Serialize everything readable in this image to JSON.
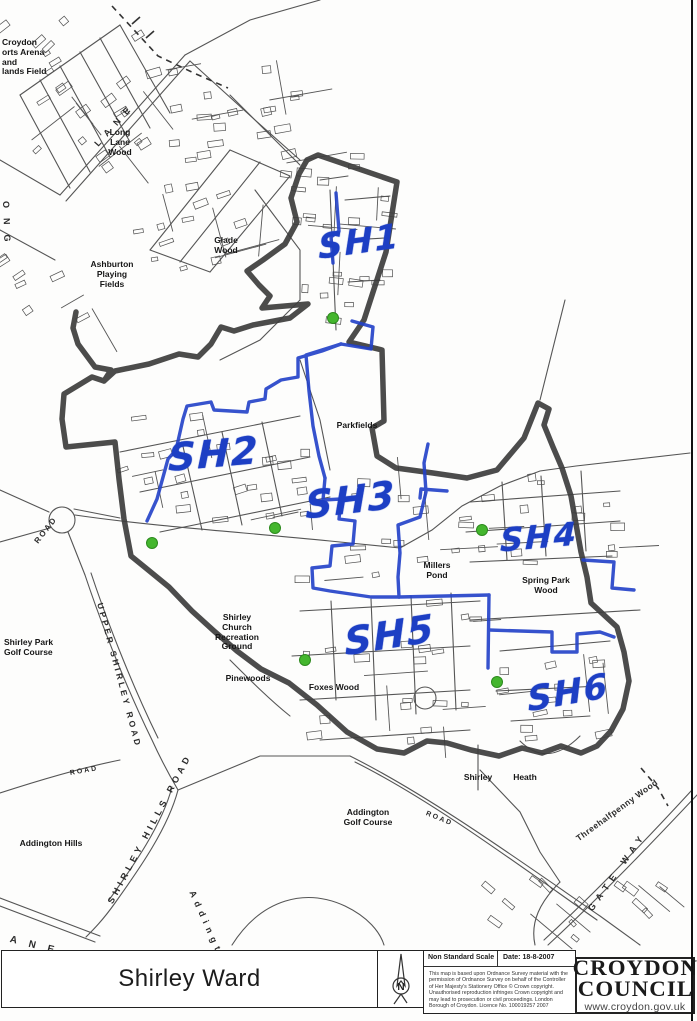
{
  "colors": {
    "boundary": "#3d3d3d",
    "district_line": "#2140c8",
    "street": "#555555",
    "green_marker": "#44b62e",
    "label_blue": "#1d3fc4"
  },
  "map": {
    "district_labels": [
      {
        "id": "sh1",
        "label": "SH1",
        "x": 318,
        "y": 222,
        "rot": -8,
        "size": 34
      },
      {
        "id": "sh2",
        "label": "SH2",
        "x": 168,
        "y": 432,
        "rot": -5,
        "size": 38
      },
      {
        "id": "sh3",
        "label": "SH3",
        "x": 305,
        "y": 478,
        "rot": -7,
        "size": 38
      },
      {
        "id": "sh4",
        "label": "SH4",
        "x": 500,
        "y": 518,
        "rot": -5,
        "size": 32
      },
      {
        "id": "sh5",
        "label": "SH5",
        "x": 344,
        "y": 613,
        "rot": -9,
        "size": 38
      },
      {
        "id": "sh6",
        "label": "SH6",
        "x": 527,
        "y": 673,
        "rot": -10,
        "size": 34
      }
    ],
    "place_labels": [
      {
        "id": "croydon-arena",
        "lines": [
          "Croydon",
          "orts Arena",
          "and",
          "lands Field"
        ],
        "x": 2,
        "y": 38,
        "align": "left"
      },
      {
        "id": "long-lane-wood",
        "lines": [
          "Long",
          "Lane",
          "Wood"
        ],
        "x": 120,
        "y": 128
      },
      {
        "id": "glade-wood",
        "lines": [
          "Glade",
          "Wood"
        ],
        "x": 226,
        "y": 236
      },
      {
        "id": "ashburton-playing-fields",
        "lines": [
          "Ashburton",
          "Playing",
          "Fields"
        ],
        "x": 112,
        "y": 260
      },
      {
        "id": "parkfields",
        "lines": [
          "Parkfields"
        ],
        "x": 357,
        "y": 421
      },
      {
        "id": "millers-pond",
        "lines": [
          "Millers",
          "Pond"
        ],
        "x": 437,
        "y": 561
      },
      {
        "id": "spring-park-wood",
        "lines": [
          "Spring Park",
          "Wood"
        ],
        "x": 546,
        "y": 576
      },
      {
        "id": "shirley-park-golf-course",
        "lines": [
          "Shirley Park",
          "Golf Course"
        ],
        "x": 4,
        "y": 638,
        "align": "left"
      },
      {
        "id": "shirley-church-recreation-ground",
        "lines": [
          "Shirley",
          "Church",
          "Recreation",
          "Ground"
        ],
        "x": 237,
        "y": 613
      },
      {
        "id": "pinewoods",
        "lines": [
          "Pinewoods"
        ],
        "x": 248,
        "y": 674
      },
      {
        "id": "foxes-wood",
        "lines": [
          "Foxes Wood"
        ],
        "x": 334,
        "y": 683
      },
      {
        "id": "addington-hills",
        "lines": [
          "Addington Hills"
        ],
        "x": 51,
        "y": 839
      },
      {
        "id": "addington-golf-course",
        "lines": [
          "Addington",
          "Golf Course"
        ],
        "x": 368,
        "y": 808
      },
      {
        "id": "shirley",
        "lines": [
          "Shirley"
        ],
        "x": 478,
        "y": 773
      },
      {
        "id": "heath",
        "lines": [
          "Heath"
        ],
        "x": 525,
        "y": 773
      }
    ],
    "road_labels": [
      {
        "id": "long-lane",
        "text": "LANE",
        "x": 96,
        "y": 140,
        "rot": -48,
        "ls": 8,
        "size": 9
      },
      {
        "id": "long",
        "text": "ONG",
        "x": 6,
        "y": 196,
        "rot": 88,
        "ls": 10,
        "size": 9
      },
      {
        "id": "upper-shirley-road",
        "text": "UPPER SHIRLEY ROAD",
        "x": 100,
        "y": 598,
        "rot": 75,
        "ls": 3,
        "size": 8.5
      },
      {
        "id": "shirley-hills-road",
        "text": "SHIRLEY HILLS ROAD",
        "x": 110,
        "y": 898,
        "rot": -62,
        "ls": 4,
        "size": 9
      },
      {
        "id": "road-west",
        "text": "ROAD",
        "x": 36,
        "y": 538,
        "rot": -52,
        "ls": 2,
        "size": 8
      },
      {
        "id": "road-nw-bottom",
        "text": "ROAD",
        "x": 70,
        "y": 770,
        "rot": -10,
        "ls": 2,
        "size": 7
      },
      {
        "id": "addington-road",
        "text": "ROAD",
        "x": 426,
        "y": 810,
        "rot": 22,
        "ls": 2,
        "size": 7
      },
      {
        "id": "threehalfpenny-wood",
        "text": "Threehalfpenny Wood",
        "x": 577,
        "y": 834,
        "rot": -36,
        "ls": 0.5,
        "size": 8.5
      },
      {
        "id": "kent-gate-way",
        "text": "GATE   WAY",
        "x": 590,
        "y": 905,
        "rot": -55,
        "ls": 6,
        "size": 9
      },
      {
        "id": "addington-curve",
        "text": "Addington",
        "x": 192,
        "y": 886,
        "rot": 66,
        "ls": 5,
        "size": 9
      },
      {
        "id": "lane-sw",
        "text": "ANE",
        "x": 10,
        "y": 934,
        "rot": 14,
        "ls": 12,
        "size": 10
      }
    ],
    "green_dots": [
      [
        333,
        318
      ],
      [
        152,
        543
      ],
      [
        275,
        528
      ],
      [
        482,
        530
      ],
      [
        305,
        660
      ],
      [
        497,
        682
      ]
    ]
  },
  "footer": {
    "title": "Shirley Ward",
    "north_letter": "N",
    "scale_label": "Non Standard Scale",
    "date_label": "Date: 18-8-2007",
    "copyright": "This map is based upon Ordnance Survey material with the permission of Ordnance Survey on behalf of the Controller of Her Majesty's Stationery Office © Crown copyright. Unauthorised reproduction infringes Crown copyright and may lead to prosecution or civil proceedings. London Borough of Croydon. Licence No. 100019257 2007",
    "logo_line1": "CROYDON",
    "logo_line2": "COUNCIL",
    "website": "www.croydon.gov.uk"
  }
}
